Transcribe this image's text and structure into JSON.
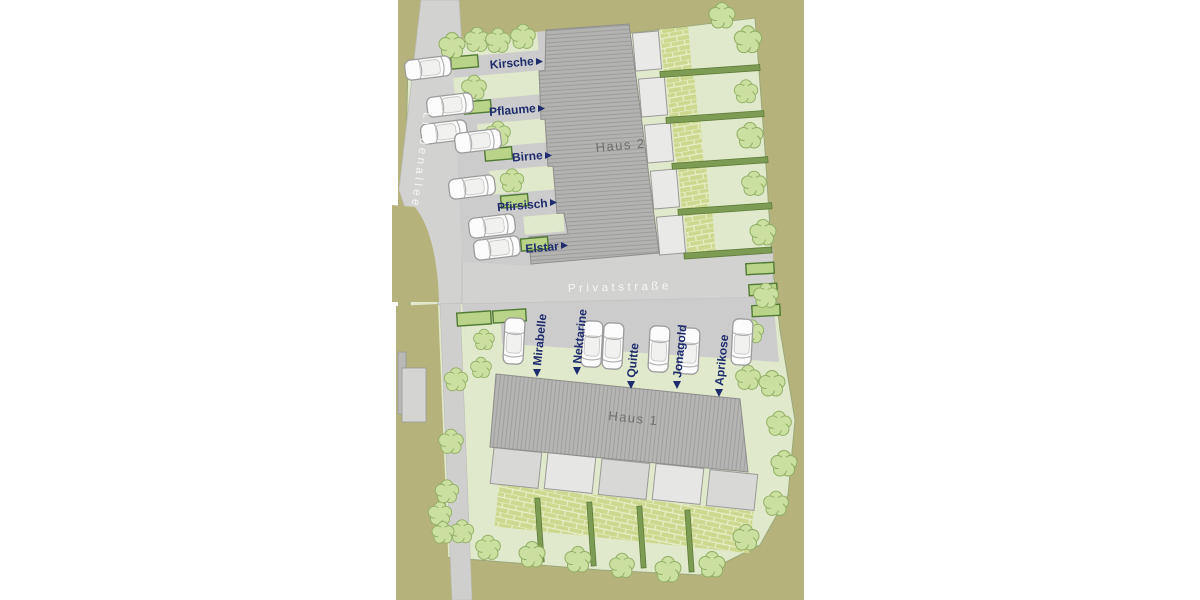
{
  "plan": {
    "streets": {
      "lindenallee": "Lindenallee",
      "privatstrasse": "Privatstraße"
    },
    "haus2": {
      "name": "Haus 2",
      "entrances": [
        {
          "label": "Kirsche"
        },
        {
          "label": "Pflaume"
        },
        {
          "label": "Birne"
        },
        {
          "label": "Pfirsisch"
        },
        {
          "label": "Elstar"
        }
      ]
    },
    "haus1": {
      "name": "Haus 1",
      "entrances": [
        {
          "label": "Mirabelle"
        },
        {
          "label": "Nektarine"
        },
        {
          "label": "Quitte"
        },
        {
          "label": "Jonagold"
        },
        {
          "label": "Aprikose"
        }
      ]
    },
    "colors": {
      "page": "#ffffff",
      "land": "#b6b27b",
      "lawn": "#e0e9cb",
      "lawn_border": "#9aa878",
      "street": "#d2d2d0",
      "building_base": "#b3b3b1",
      "building_text": "#6f6f6d",
      "terrace": "#e9e9e7",
      "brick": "#ccd88e",
      "hedge_fill": "#b9d489",
      "hedge_stroke": "#507a33",
      "hedgerow": "#7d9b52",
      "tree_fill": "#cbe0a0",
      "tree_stroke": "#8fae63",
      "car_body": "#fcfcfc",
      "car_stroke": "#9b9b9b",
      "label_text": "#1e2c6e",
      "street_text": "#ffffff"
    }
  }
}
